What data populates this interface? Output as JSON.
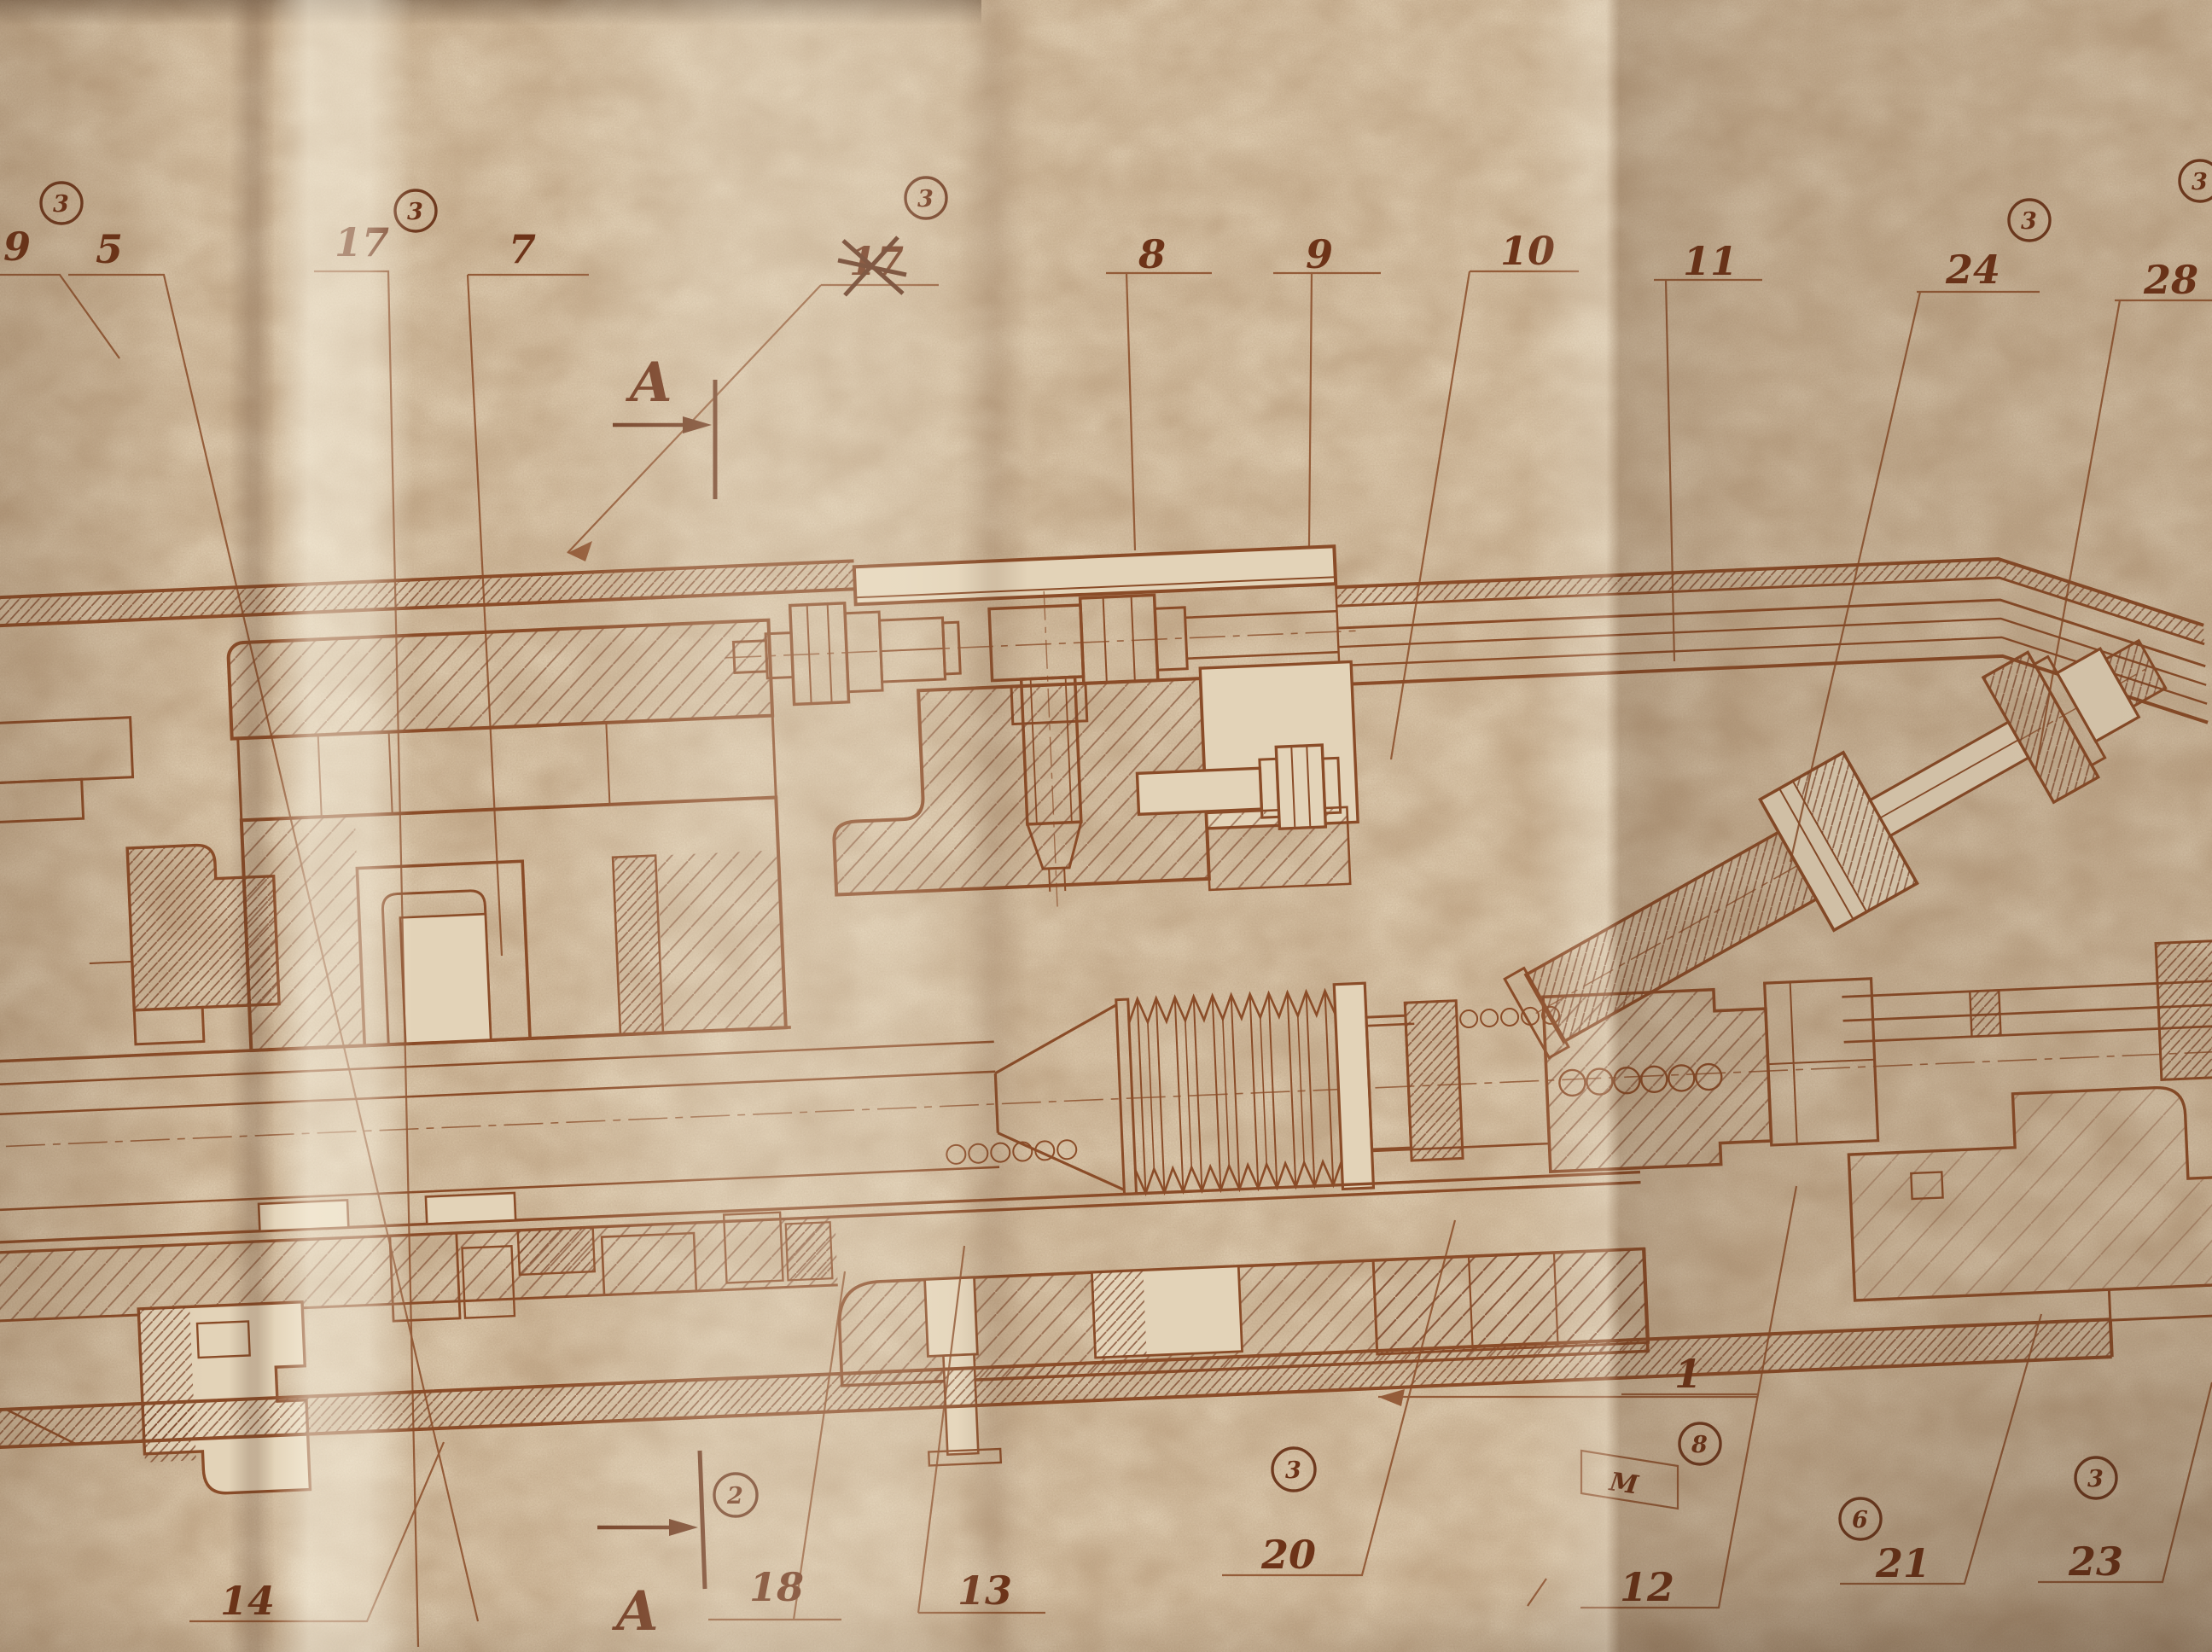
{
  "drawing_type": "sepia mechanical assembly cross-section blueprint photographed on folded aged paper",
  "colors": {
    "paper": "#dcc9ad",
    "ink": "#6f3a1f",
    "ink-medium": "#8a4c28",
    "label-ink": "#6d3318"
  },
  "labels": {
    "t9": "9",
    "t5": "5",
    "t17": "17",
    "t7": "7",
    "t17x": "17",
    "t8": "8",
    "t9b": "9",
    "t10": "10",
    "t11": "11",
    "t24": "24",
    "t28": "28",
    "b14": "14",
    "b18": "18",
    "b13": "13",
    "b20": "20",
    "b12": "12",
    "b1": "1",
    "b21": "21",
    "b23": "23",
    "bM": "M"
  },
  "section_marks": {
    "top": "A",
    "bottom": "A"
  },
  "stamps": {
    "s1": "3",
    "s2": "3",
    "s3": "3",
    "s4": "3",
    "s5": "3",
    "s6": "2",
    "s7": "3",
    "s8": "8",
    "s9": "6",
    "s10": "3"
  }
}
